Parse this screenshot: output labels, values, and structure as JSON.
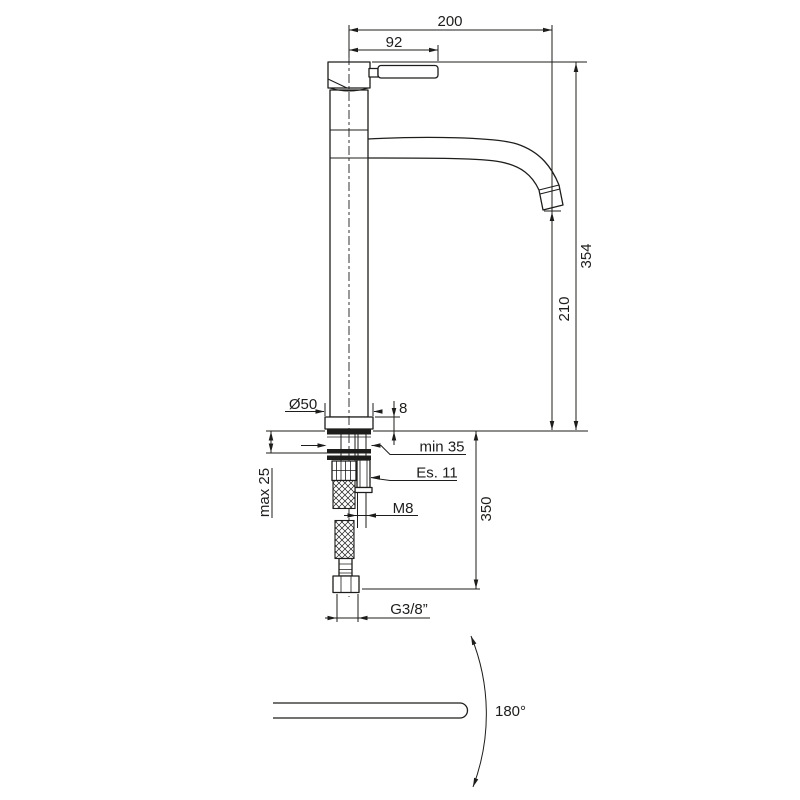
{
  "theme": {
    "background": "#ffffff",
    "line_color": "#1d1d1b"
  },
  "front_view": {
    "dims": {
      "overall_reach": "200",
      "handle_reach": "92",
      "overall_height": "354",
      "spout_height": "210",
      "base_diameter": "Ø50",
      "base_plate_height": "8",
      "mounting_hole": "min 35",
      "hex_wrench": "Es. 11",
      "deck_thickness": "max 25",
      "stud_thread": "M8",
      "hose_drop": "350",
      "supply_thread": "G3/8”"
    }
  },
  "top_view": {
    "swivel_angle": "180°"
  }
}
